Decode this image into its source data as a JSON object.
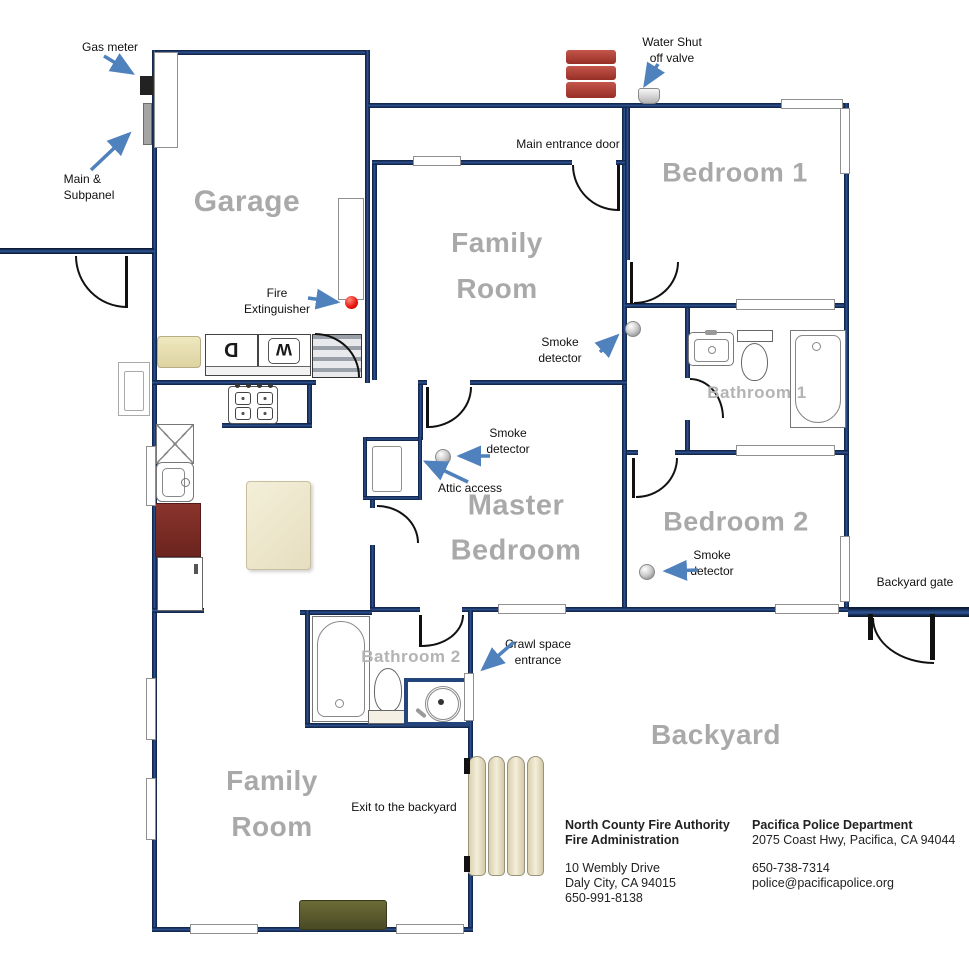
{
  "rooms": {
    "garage": "Garage",
    "family_room_top": {
      "line1": "Family",
      "line2": "Room"
    },
    "bedroom1": "Bedroom 1",
    "master": {
      "line1": "Master",
      "line2": "Bedroom"
    },
    "bedroom2": "Bedroom 2",
    "bathroom1": "Bathroom 1",
    "bathroom2": "Bathroom 2",
    "family_room_bottom": {
      "line1": "Family",
      "line2": "Room"
    },
    "backyard": "Backyard"
  },
  "annotations": {
    "gas_meter": "Gas meter",
    "main_subpanel": {
      "line1": "Main &",
      "line2": "Subpanel"
    },
    "water_valve": {
      "line1": "Water Shut",
      "line2": "off valve"
    },
    "main_entrance_door": "Main entrance door",
    "fire_extinguisher": {
      "line1": "Fire",
      "line2": "Extinguisher"
    },
    "smoke_detector": {
      "line1": "Smoke",
      "line2": "detector"
    },
    "attic_access": "Attic access",
    "crawl_space": {
      "line1": "Crawl space",
      "line2": "entrance"
    },
    "backyard_gate": "Backyard gate",
    "exit_backyard": "Exit to the backyard"
  },
  "appliances": {
    "dryer_label": "D",
    "washer_label": "W"
  },
  "contacts": {
    "fire": {
      "org": "North County Fire Authority",
      "dept": "Fire Administration",
      "address1": "10 Wembly Drive",
      "address2": "Daly City, CA 94015",
      "phone": "650-991-8138"
    },
    "police": {
      "org": "Pacifica Police Department",
      "address": "2075 Coast Hwy, Pacifica, CA 94044",
      "phone": "650-738-7314",
      "email": "police@pacificapolice.org"
    }
  },
  "colors": {
    "wall_blue": "#1f3864",
    "arrow_blue": "#4f81bd",
    "room_label_gray": "#a9a9a9",
    "chimney_red": "#a93c32",
    "fire_dot_red": "#e8100c",
    "fridge_maroon": "#792b24",
    "deck_cream": "#ece3c5",
    "mat_olive": "#55552a"
  }
}
